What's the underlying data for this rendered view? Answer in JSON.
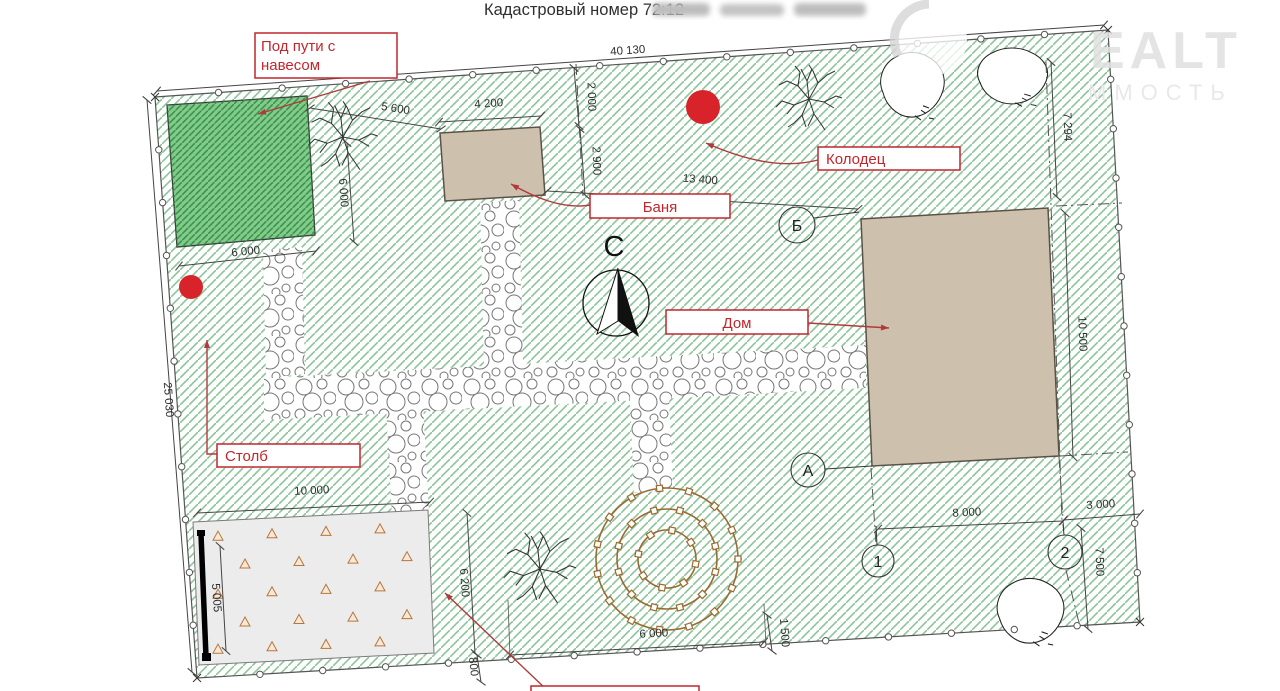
{
  "header": {
    "title": "Кадастровый номер 72:12"
  },
  "watermark": {
    "big": "EALT",
    "small": "ММОСТЬ"
  },
  "north_label": "С",
  "callouts": {
    "canopy_line1": "Под пути с",
    "canopy_line2": "навесом",
    "well": "Колодец",
    "bathhouse": "Баня",
    "house": "Дом",
    "post": "Столб"
  },
  "axes": {
    "b": "Б",
    "a": "А",
    "n1": "1",
    "n2": "2"
  },
  "dimensions": {
    "top_width": "40 130",
    "left_height": "25 030",
    "gap_canopy_bath": "5 600",
    "bath_width": "4 200",
    "bath_offset": "2 000",
    "bath_depth": "2 900",
    "bath_to_house": "13 400",
    "canopy_width_bottom": "6 000",
    "canopy_side": "6 000",
    "right_top": "7 294",
    "house_height": "10 500",
    "garden_width": "10 000",
    "gate_length": "5 005",
    "garden_right": "6 200",
    "small_800": "800",
    "flowerbed_width": "6 000",
    "offset_1500": "1 500",
    "axis_1_2": "8 000",
    "axis_2_right": "3 000",
    "right_bottom": "7 500"
  },
  "colors": {
    "accent_red": "#d8232a",
    "callout_red": "#c0272d",
    "hatch_green": "#63b274",
    "canopy_fill": "#84ca8b",
    "building_fill": "#cdc1ae",
    "garden_gray": "#ececec",
    "flowerbed_brown": "#9a6a30",
    "dim_text": "#2e2e2e"
  }
}
